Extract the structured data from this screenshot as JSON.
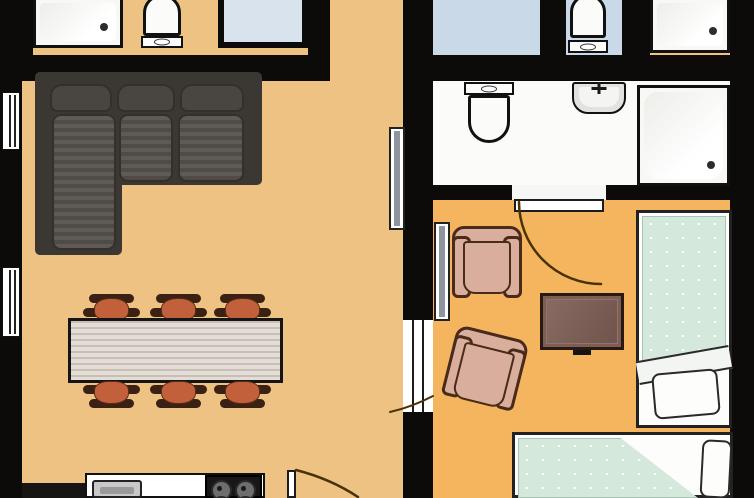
{
  "canvas": {
    "width": 754,
    "height": 498
  },
  "plan": {
    "type": "apartment-floor-plan-top-view",
    "rooms": [
      {
        "id": "living-dining-kitchen",
        "floor": "tan",
        "fixtures": [
          "corner-sofa",
          "dining-table",
          "stool",
          "stool",
          "stool",
          "stool",
          "stool",
          "stool",
          "kitchen-counter",
          "kitchen-sink",
          "gas-hob",
          "window",
          "window",
          "entry-door-swing",
          "appliance-block",
          "sliding-panel"
        ]
      },
      {
        "id": "hallway-top",
        "floor": "tan",
        "fixtures": []
      },
      {
        "id": "bathroom-top-left",
        "floor": "tan",
        "fixtures": [
          "shower-tray",
          "toilet",
          "glass-shower-tub"
        ]
      },
      {
        "id": "wc-top-right-a",
        "floor": "light-blue",
        "fixtures": []
      },
      {
        "id": "wc-top-right-b",
        "floor": "light-blue",
        "fixtures": [
          "toilet"
        ]
      },
      {
        "id": "shower-room-top-right",
        "floor": "white",
        "fixtures": [
          "shower-tray"
        ]
      },
      {
        "id": "bathroom-right",
        "floor": "white",
        "fixtures": [
          "toilet",
          "washbasin",
          "shower-tray",
          "door-leaf",
          "door-swing"
        ]
      },
      {
        "id": "bedroom-right",
        "floor": "orange",
        "fixtures": [
          "armchair",
          "armchair",
          "tv-stand",
          "single-bed",
          "single-bed",
          "pillow",
          "pillow",
          "sliding-panel",
          "doorway"
        ]
      }
    ],
    "counts": {
      "stools": 6,
      "armchairs": 2,
      "beds": 2,
      "toilets": 3,
      "shower_trays": 3,
      "windows": 2,
      "door_swings": 3
    }
  },
  "colors": {
    "floor_living": "#edc283",
    "floor_bedroom": "#f4b55e",
    "floor_bath_white": "#fbfbfa",
    "floor_bath_blue": "#c9d9e8",
    "wall": "#0c0b0a",
    "bed_linen": "#d4e8dc",
    "pillow": "#fdfdfb",
    "sofa_base": "#3b3733",
    "sofa_cushion": "#56514c",
    "stool_body": "#c2603c",
    "stool_cap": "#3b2114",
    "table_top": "#d9d2c9",
    "armchair": "#d9ae9c",
    "tv_table": "#7d5e55",
    "counter": "#ffffff",
    "kitchen_sink": "#c8c8c8",
    "glass_tub": "#d9e3ee",
    "door_arc": "#4a3208"
  }
}
